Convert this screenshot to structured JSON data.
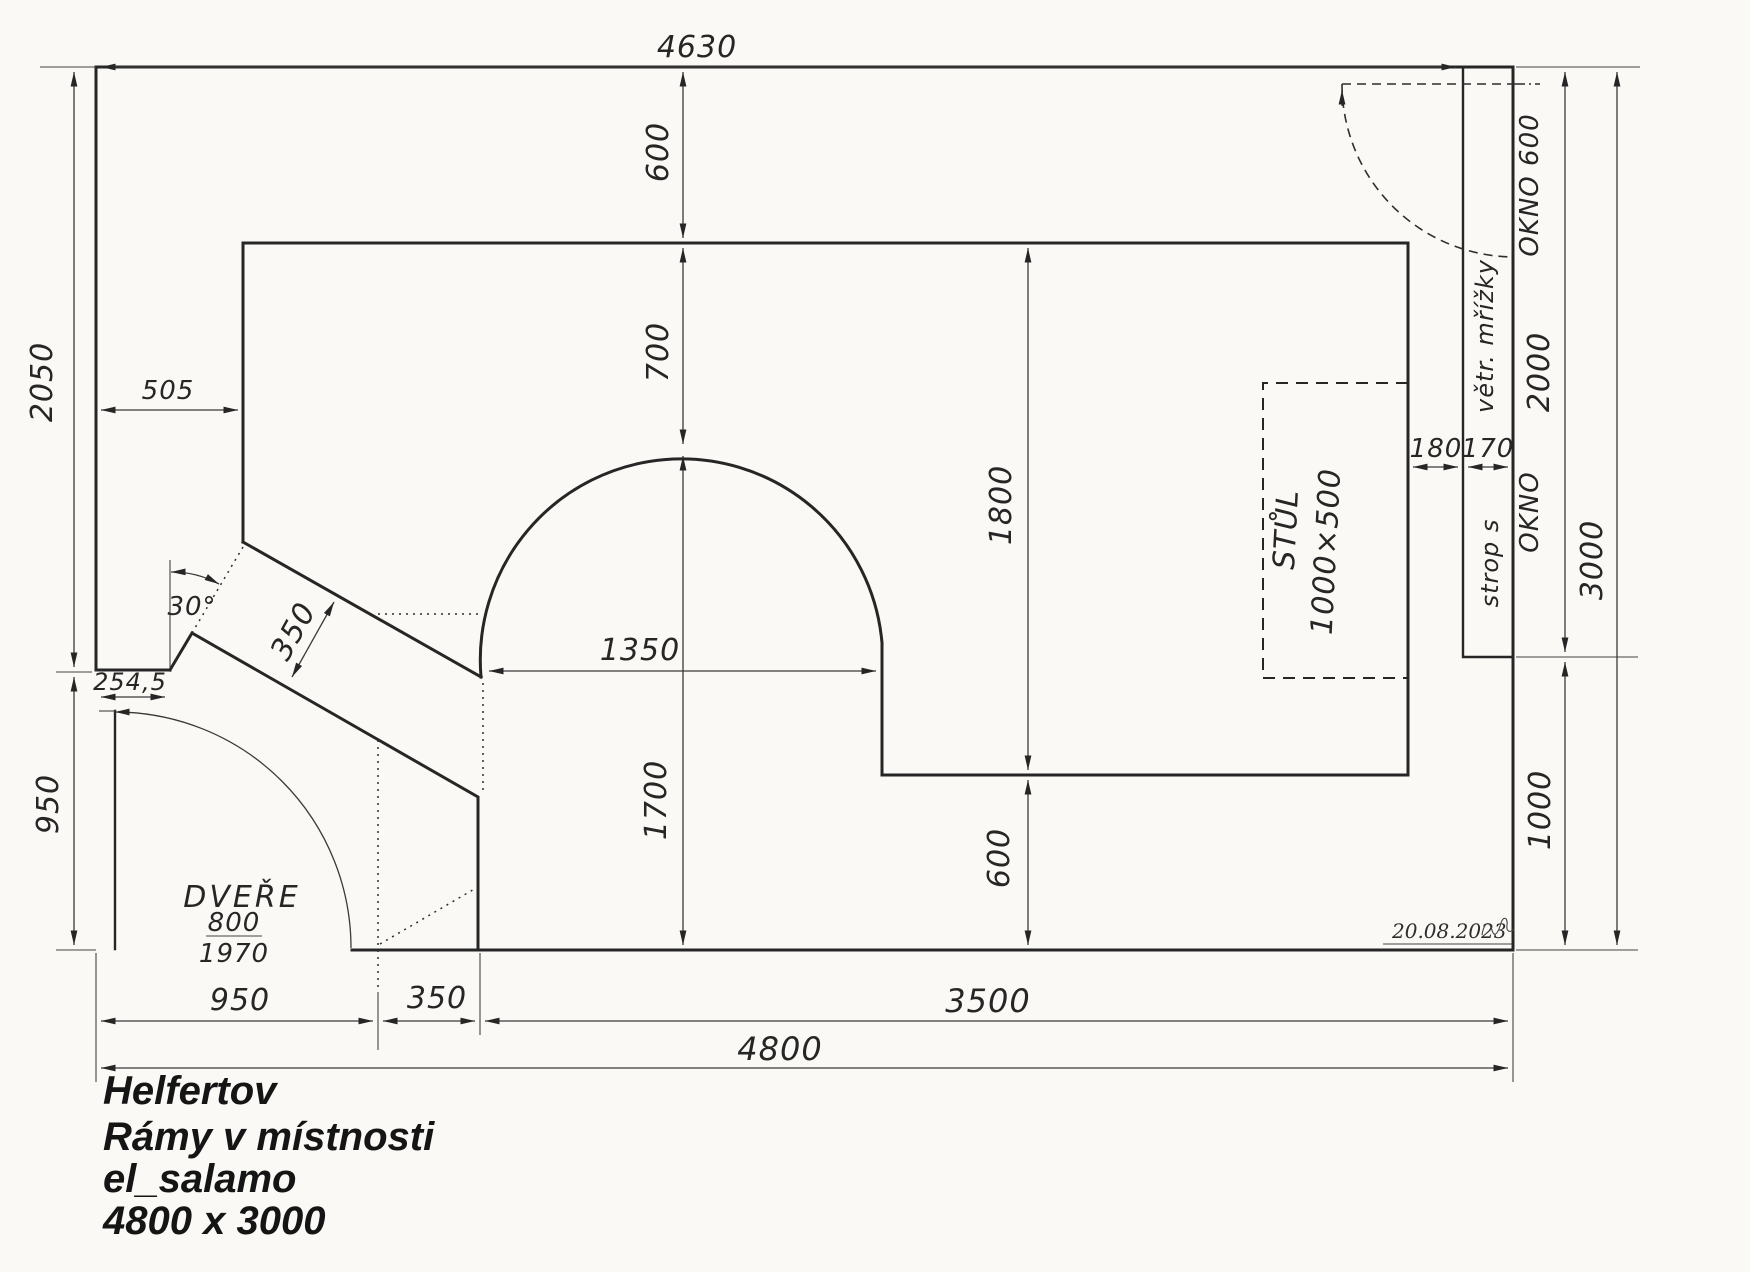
{
  "drawing": {
    "dims": {
      "top_4630": "4630",
      "v600_top": "600",
      "v700": "700",
      "v1700": "1700",
      "v1800": "1800",
      "v600_bottom": "600",
      "h1350": "1350",
      "h505": "505",
      "h254": "254,5",
      "band350": "350",
      "angle30": "30°",
      "left2050": "2050",
      "left950": "950",
      "r180": "180",
      "r170": "170",
      "r2000": "2000",
      "r3000": "3000",
      "r1000": "1000",
      "b950": "950",
      "b350": "350",
      "b3500": "3500",
      "b4800": "4800"
    },
    "labels": {
      "door_title": "DVEŘE",
      "door_width": "800",
      "door_height": "1970",
      "table": "STŮL",
      "table_size": "1000×500",
      "window_top": "OKNO 600",
      "vent_grilles": "větr. mřížky",
      "window_side": "OKNO",
      "ceiling": "strop  s"
    },
    "signature": "20.08.2023",
    "title_block": {
      "l1": "Helfertov",
      "l2": "Rámy v místnosti",
      "l3": "el_salamo",
      "l4": "4800 x 3000"
    }
  }
}
